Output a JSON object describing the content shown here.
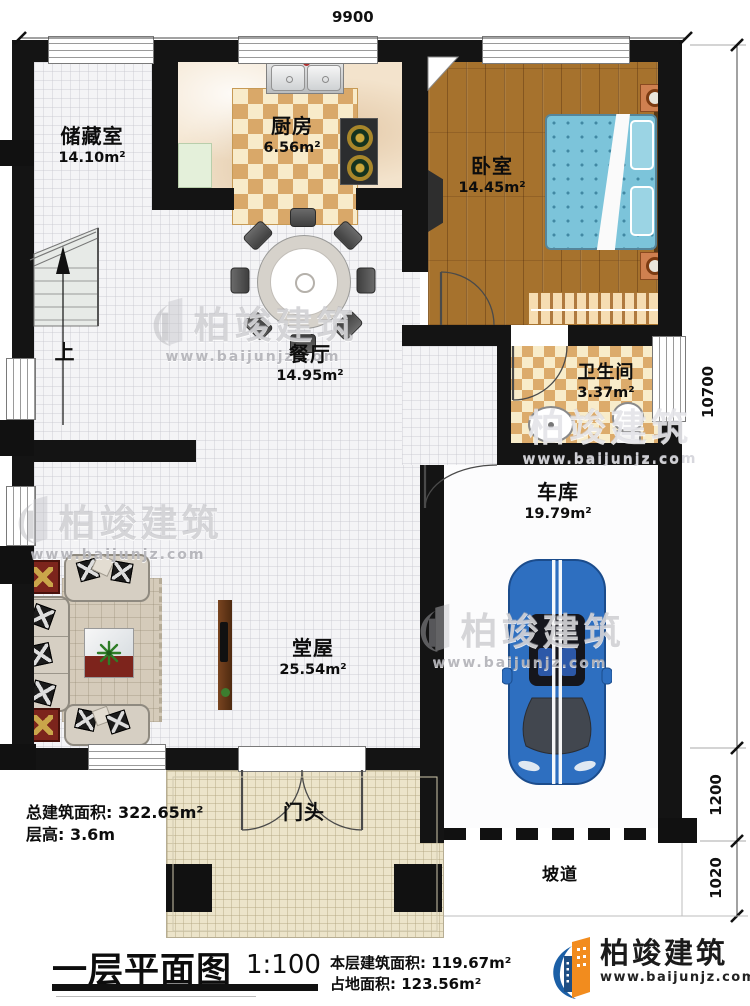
{
  "dimensions": {
    "width_top": "9900",
    "height_right": "10700",
    "right_mid": "1200",
    "right_low": "1020"
  },
  "rooms": {
    "storage": {
      "name": "储藏室",
      "area": "14.10m²"
    },
    "kitchen": {
      "name": "厨房",
      "area": "6.56m²"
    },
    "bedroom": {
      "name": "卧室",
      "area": "14.45m²"
    },
    "dining": {
      "name": "餐厅",
      "area": "14.95m²"
    },
    "bathroom": {
      "name": "卫生间",
      "area": "3.37m²"
    },
    "garage": {
      "name": "车库",
      "area": "19.79m²"
    },
    "hall": {
      "name": "堂屋",
      "area": "25.54m²"
    },
    "porch": {
      "name": "门头"
    },
    "ramp": {
      "name": "坡道"
    }
  },
  "stairs": {
    "direction_label": "上"
  },
  "summary": {
    "total_area": "总建筑面积: 322.65m²",
    "floor_height": "层高: 3.6m"
  },
  "title_block": {
    "plan_title": "一层平面图",
    "scale": "1:100",
    "floor_area": "本层建筑面积: 119.67m²",
    "site_area": "占地面积: 123.56m²"
  },
  "brand": {
    "name": "柏竣建筑",
    "website": "www.baijunjz.com"
  },
  "colors": {
    "wall": "#141414",
    "wood_floor": "#a6722d",
    "bed_blue": "#7cc4da",
    "checker_tan": "#d9a869",
    "car_blue": "#2e6fc0",
    "brand_blue": "#1b5fa6",
    "brand_orange": "#f28c1e"
  }
}
